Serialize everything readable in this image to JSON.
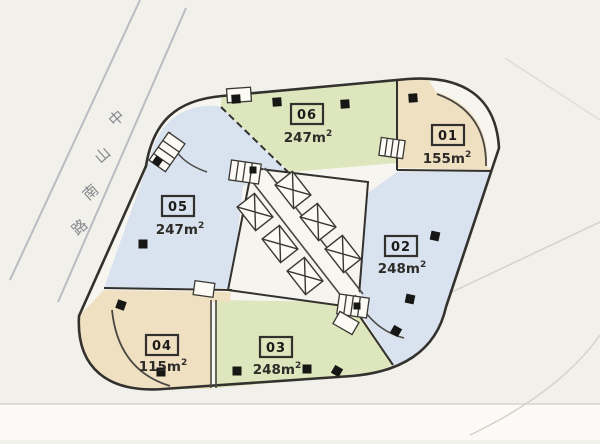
{
  "street": {
    "name": "中山南路",
    "chars": [
      "中",
      "山",
      "南",
      "路"
    ]
  },
  "units": [
    {
      "id": "01",
      "area": "155m",
      "sup": "2",
      "zone": "tan"
    },
    {
      "id": "02",
      "area": "248m",
      "sup": "2",
      "zone": "blue"
    },
    {
      "id": "03",
      "area": "248m",
      "sup": "2",
      "zone": "green"
    },
    {
      "id": "04",
      "area": "115m",
      "sup": "2",
      "zone": "tan"
    },
    {
      "id": "05",
      "area": "247m",
      "sup": "2",
      "zone": "blue"
    },
    {
      "id": "06",
      "area": "247m",
      "sup": "2",
      "zone": "green"
    }
  ],
  "colors": {
    "green": "#dde6bc",
    "blue": "#d9e2ef",
    "tan": "#f0e0c2",
    "floor": "#f7f5ef",
    "bg": "#f2f0ea",
    "wall": "#33312e",
    "column": "#161614"
  }
}
